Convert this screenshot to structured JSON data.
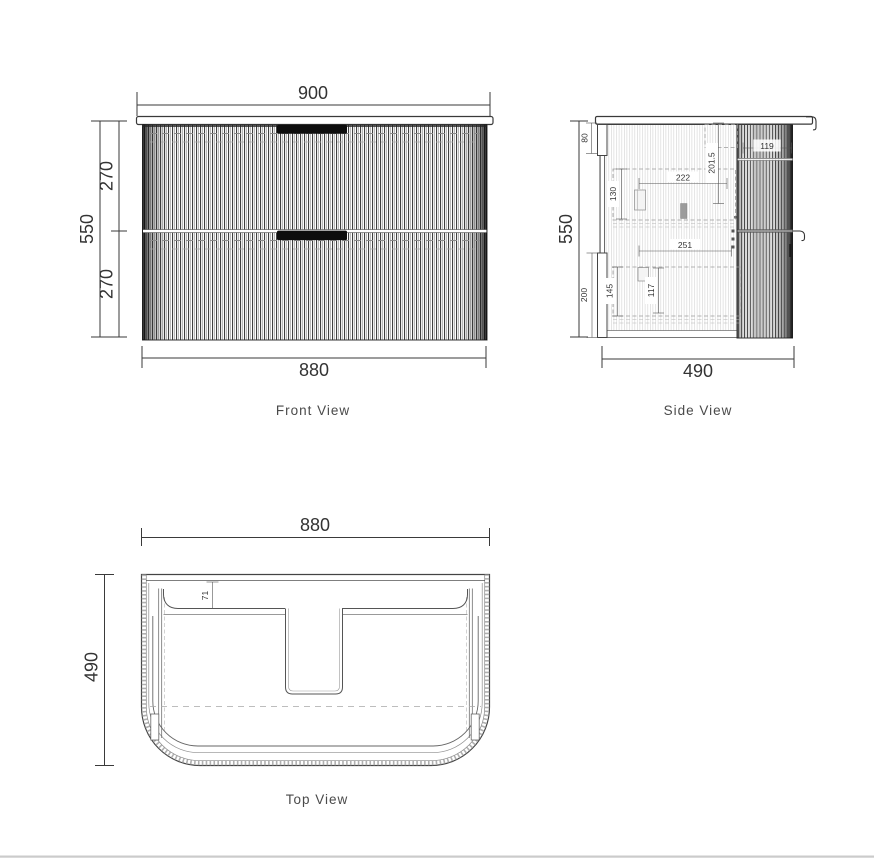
{
  "page": {
    "background": "#ffffff",
    "footer_line_color": "#cbcbcb",
    "line_color": "#3a3a3a",
    "dim_text_color": "#333333",
    "label_color": "#4a4a4a"
  },
  "views": {
    "front": {
      "label": "Front View",
      "dims": {
        "top_width": "900",
        "overall_height": "550",
        "upper_drawer_height": "270",
        "lower_drawer_height": "270",
        "cabinet_width": "880"
      }
    },
    "side": {
      "label": "Side View",
      "dims": {
        "overall_height": "550",
        "depth": "490",
        "wall_bracket_top": "80",
        "top_recess_depth": "201.5",
        "handle_clearance": "119",
        "upper_drawer_inner_height": "130",
        "upper_drawer_inner_depth": "222",
        "lower_drawer_inner_depth": "251",
        "wall_bracket_bottom": "200",
        "lower_drawer_inner_height": "145",
        "lower_drawer_basket_height": "117"
      }
    },
    "top": {
      "label": "Top View",
      "dims": {
        "width": "880",
        "depth": "490",
        "front_inset": "71"
      }
    }
  }
}
